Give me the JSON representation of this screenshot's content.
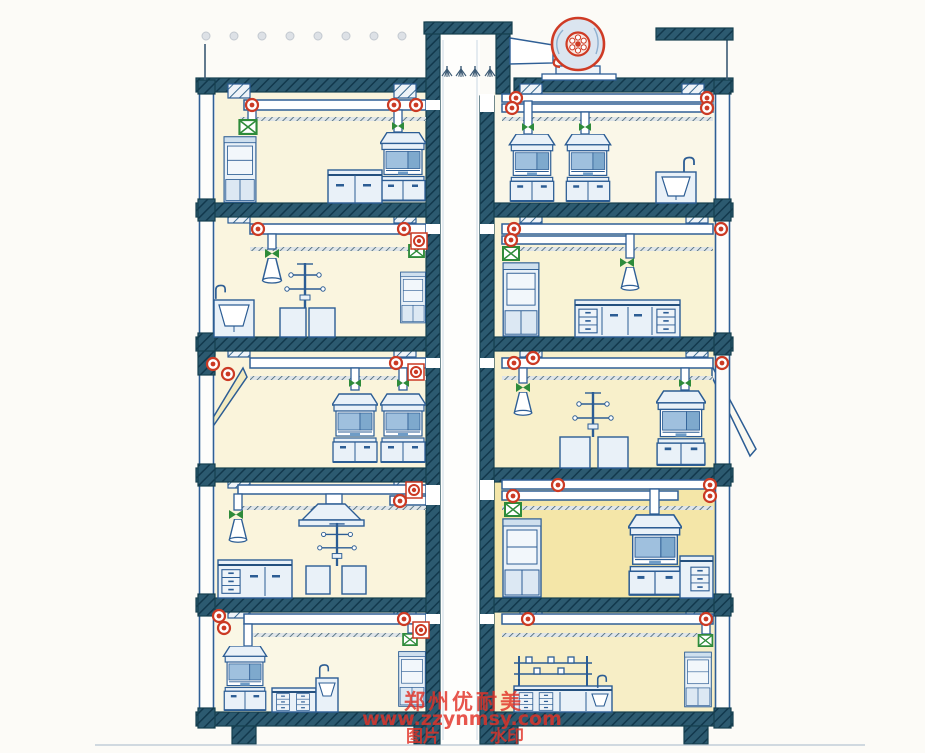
{
  "meta": {
    "title": "Laboratory building central exhaust ventilation system - hand drawn sectional diagram",
    "style": "colored-pencil technical drawing",
    "floors_shown": 5,
    "rooms_per_floor": 2
  },
  "watermark": {
    "line1": "郑州优耐美",
    "line2": "www.zzynmsy.com",
    "line3_left": "图片",
    "line3_right": "水印",
    "color": "#e23227"
  },
  "colors": {
    "outline_blue": "#2c5d94",
    "slab_dark_teal": "#2c5a70",
    "equipment_light_blue": "#e9f1f8",
    "hood_window_blue": "#9fc0de",
    "room_tint_yellow": "#f3e49a",
    "damper_red": "#cb3a24",
    "valve_green": "#2e8b3a",
    "fan_red": "#cf3b25",
    "watermark_red": "#e23227",
    "background": "#fcfbf7"
  },
  "rooftop": {
    "fan": "centrifugal roof exhaust fan on pedestal",
    "fan_connection": "tapered inlet duct from central shaft penthouse",
    "shaft_cap": "dark penthouse cap over central exhaust shaft",
    "spray_nozzles_in_shaft": 4,
    "roof_guardrail_dots": 8,
    "right_parapet": "raised dark parapet slab at top right"
  },
  "shaft": {
    "name": "central vertical exhaust shaft",
    "extent": "roof penthouse to foundation",
    "connections": "horizontal ceiling ducts from every room on every floor"
  },
  "legend_symbols": {
    "red_circle": "inline damper / branch fan on duct",
    "green_x_box": "ventilated cabinet exhaust grille damper",
    "green_bowtie": "shut-off valve on branch duct",
    "funnel": "flexible snorkel extraction funnel",
    "asterisk": "spray nozzle in shaft"
  },
  "floors": [
    {
      "level": 1,
      "left": {
        "equipment": [
          "ducted storage cabinet with green damper",
          "lab bench with cabinets",
          "fume hood with riser duct"
        ],
        "red_dampers": 3
      },
      "right": {
        "equipment": [
          "double fume hood",
          "double fume hood",
          "sink unit with gooseneck faucet"
        ],
        "red_dampers": 4
      }
    },
    {
      "level": 2,
      "left": {
        "equipment": [
          "sink unit with faucet",
          "snorkel funnel extractor",
          "island bench with reagent rack",
          "tall ducted cabinet"
        ],
        "red_dampers": 3
      },
      "right": {
        "equipment": [
          "tall ducted cabinet with green damper",
          "snorkel funnel extractor",
          "bench with drawers and doors"
        ],
        "red_dampers": 3
      }
    },
    {
      "level": 3,
      "left": {
        "equipment": [
          "open facade with sloped awning",
          "fume hood",
          "fume hood"
        ],
        "red_dampers": 4
      },
      "right": {
        "equipment": [
          "snorkel funnel extractor",
          "island bench with reagent rack",
          "fume hood",
          "sloped awning at right facade"
        ],
        "red_dampers": 3
      }
    },
    {
      "level": 4,
      "left": {
        "equipment": [
          "snorkel funnel extractor",
          "canopy hood over bench area",
          "bench with drawer stack",
          "island bench with reagent rack"
        ],
        "red_dampers": 2
      },
      "right": {
        "equipment": [
          "tall ducted cabinet with green damper",
          "fume hood",
          "bench with drawers"
        ],
        "red_dampers": 4
      }
    },
    {
      "level": 5,
      "left": {
        "equipment": [
          "fume hood",
          "bench with drawers",
          "sink unit with faucet",
          "tall ducted cabinet with green damper"
        ],
        "red_dampers": 4
      },
      "right": {
        "equipment": [
          "shelved island bench with sink and faucet",
          "tall ducted cabinet with green damper"
        ],
        "red_dampers": 2
      }
    }
  ]
}
